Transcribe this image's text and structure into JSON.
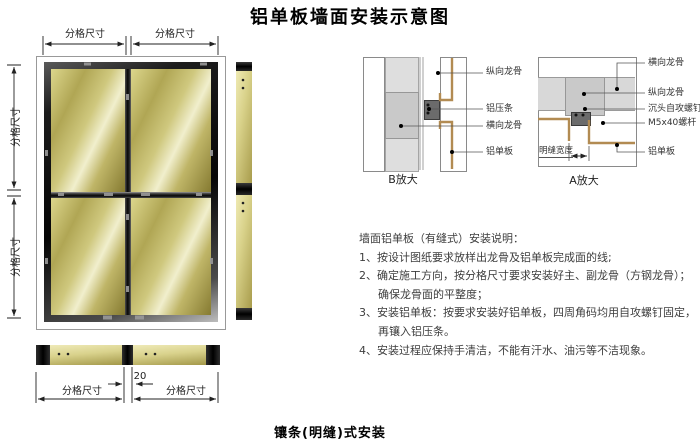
{
  "title": "铝单板墙面安装示意图",
  "footer_caption": "镶条(明缝)式安装",
  "elevation": {
    "dim_top_left": "分格尺寸",
    "dim_top_right": "分格尺寸",
    "dim_side_top": "分格尺寸",
    "dim_side_bottom": "分格尺寸",
    "dim_bottom_left": "分格尺寸",
    "dim_bottom_right": "分格尺寸",
    "gap_dim": "20"
  },
  "detail_b": {
    "caption": "B放大",
    "labels": [
      "纵向龙骨",
      "铝压条",
      "横向龙骨",
      "铝单板"
    ]
  },
  "detail_a": {
    "caption": "A放大",
    "seam_width_label": "明缝宽度",
    "labels": [
      "横向龙骨",
      "纵向龙骨",
      "沉头自攻螺钉",
      "M5x40螺杆",
      "铝单板"
    ]
  },
  "notes": {
    "lines": [
      "墙面铝单板（有缝式）安装说明：",
      "1、按设计图纸要求放样出龙骨及铝单板完成面的线;",
      "2、确定施工方向，按分格尺寸要求安装好主、副龙骨（方钢龙骨）；",
      "确保龙骨面的平整度；",
      "3、安装铝单板：按要求安装好铝单板，四周角码均用自攻螺钉固定，",
      "再镶入铝压条。",
      "4、安装过程应保持手清洁，不能有汗水、油污等不洁现象。"
    ]
  },
  "colors": {
    "panel_gold": "#b9ae5c",
    "frame_dark": "#111111",
    "profile_tan": "#b28b52",
    "keel_gray": "#c9c9c9"
  }
}
